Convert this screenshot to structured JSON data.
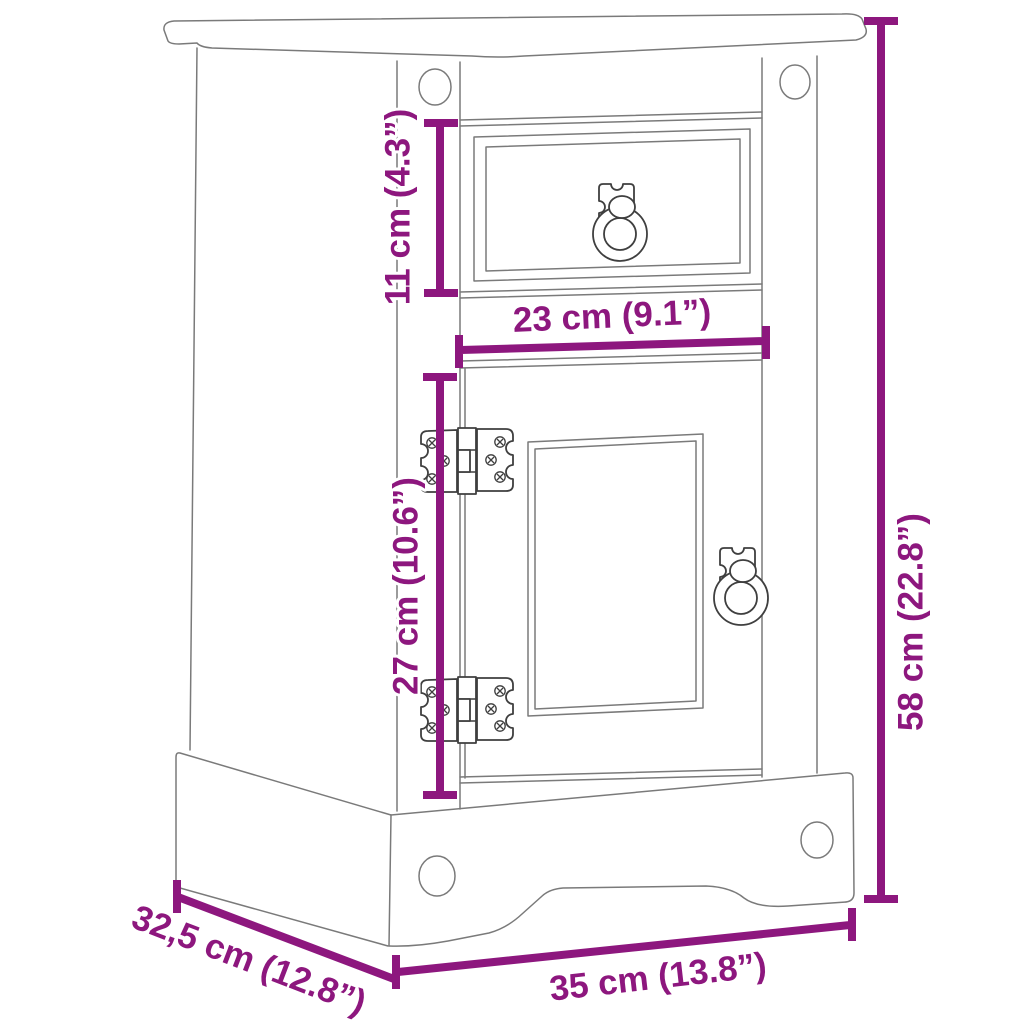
{
  "colors": {
    "dimension": "#8D177E",
    "outline": "#7A7A7A",
    "hardware": "#3F3F3F",
    "background": "#FFFFFF"
  },
  "diagram": {
    "kind": "furniture-dimension-line-drawing",
    "item": "bedside cabinet with one drawer and one door",
    "labels": {
      "drawer_height": "11 cm (4.3”)",
      "drawer_width": "23 cm (9.1”)",
      "door_height": "27 cm (10.6”)",
      "overall_height": "58 cm (22.8”)",
      "overall_width": "35 cm (13.8”)",
      "overall_depth": "32,5 cm (12.8”)"
    }
  }
}
